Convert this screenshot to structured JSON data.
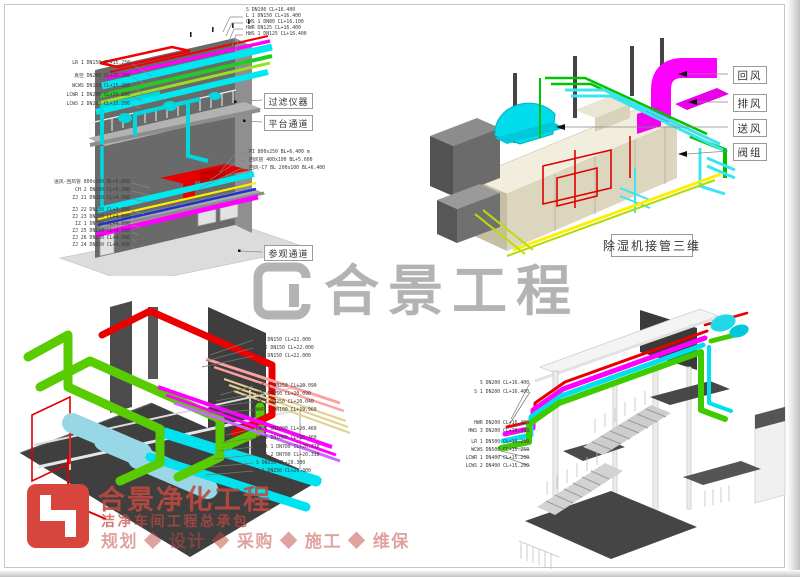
{
  "watermark": {
    "text": "合景工程"
  },
  "logo": {
    "title": "合景净化工程",
    "subtitle": "洁净车间工程总承包",
    "services": "规划 ◆ 设计 ◆ 采购 ◆ 施工 ◆ 维保"
  },
  "colors": {
    "pipe_magenta": "#ff00ff",
    "pipe_cyan": "#00e5ee",
    "pipe_red": "#ea0000",
    "pipe_green": "#33cc00",
    "pipe_lime": "#99dd22",
    "pipe_yellow": "#ffee00",
    "pipe_blue": "#2233cc",
    "watermark_gray": "#b3b3b3",
    "logo_red": "#d8453c"
  },
  "diagram1": {
    "pipe_labels_upper_right": [
      "S DN100 CL+16.400",
      "L 1 DN150 CL+16.400",
      "CWS 1 DN80 CL+16.100",
      "HWR DN125 CL+16.400",
      "HWS 1 DN125 CL+16.400"
    ],
    "pipe_labels_upper_left": [
      "LR 1 DN150 CL+15.250",
      "真空 DN200 CL+15.200",
      "WCWS DN150 CL+15.250",
      "LCWR 1 DN200 CL+15.200",
      "LCWS 2 DN200 CL+15.200"
    ],
    "duct_labels_right": [
      "PI 800x250 BL+6.400 m",
      "回风管 400x100 BL+5.600",
      "回风-C7 BL 200x100 BL+6.400"
    ],
    "pipe_labels_lower_left": [
      "送风-回风管 800x100 BL+5.650",
      "CH 2 DN100 CL+5.200",
      "ZJ 21 DN150 CL+4.600",
      "ZJ 22 DN150 CL+4.600",
      "ZJ 23 DN150 CL+4.600",
      "IZ 1 DN100 CL+4.600",
      "ZJ 25 DN150 CL+4.600",
      "ZJ 26 DN150 CL+4.600",
      "ZJ 24 DN150 CL+4.600"
    ],
    "callouts": {
      "filter_instrument": "过滤仪器",
      "platform_walkway": "平台通道",
      "visitor_walkway": "参观通道"
    }
  },
  "diagram2": {
    "callouts": {
      "return_air": "回风",
      "exhaust_air": "排风",
      "supply_air": "送风",
      "valve_group": "阀组"
    },
    "caption": "除湿机接管三维"
  },
  "diagram3": {
    "pipe_labels_top": [
      "N 9 DN150 CL+22.000",
      "F 22 DN150 CL+22.000",
      "F 3 DN150 CL+22.000"
    ],
    "pipe_labels_mid": [
      "HWS 3 DN250 CL+20.090",
      "HWR DN250 CL+20.090",
      "CW 1 DN250 CL+20.040",
      "WWP 1 DN100 CL+19.960"
    ],
    "pipe_labels_bottom": [
      "LR 1 DN1000 CL+20.460",
      "WCWS DN1000 CL+20.460",
      "LCWR 1 DN700 CL+20.310",
      "LCWS 2 DN700 CL+20.310",
      "S DN350 CL+20.300",
      "S 1 DN250 CL+20.300"
    ]
  },
  "diagram4": {
    "pipe_labels_top": [
      "S DN200 CL+16.400",
      "S 1 DN200 CL+16.400"
    ],
    "pipe_labels_mid": [
      "HWR DN200 CL+16.400",
      "HWS 3 DN200 CL+16.400"
    ],
    "pipe_labels_bottom": [
      "LR 1 DN500 CL+15.250",
      "WCWS DN500 CL+15.250",
      "LCWR 1 DN400 CL+15.200",
      "LCWS 2 DN400 CL+15.200"
    ]
  }
}
